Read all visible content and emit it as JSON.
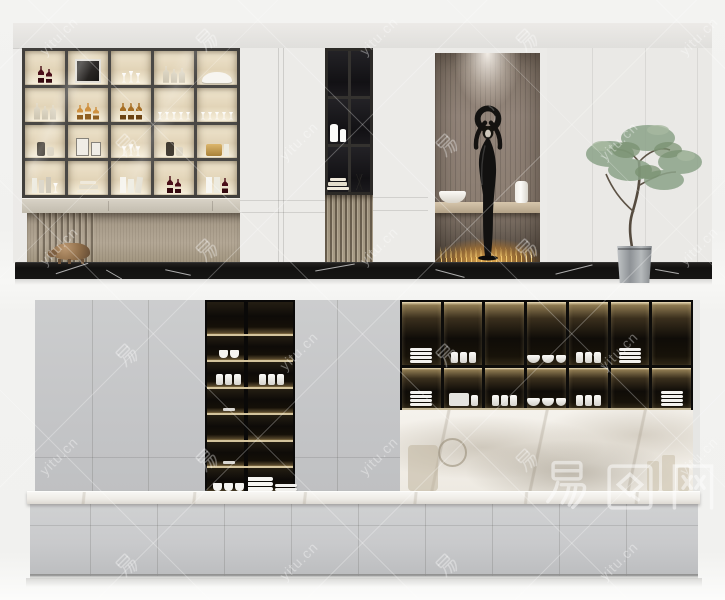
{
  "scene": {
    "description": "two-panel 3d render of modern cabinetry",
    "panels": [
      {
        "name": "display-wall",
        "elements": [
          "glass-display-cabinet",
          "white-cabinets",
          "dark-shelf-unit",
          "statue-niche",
          "paneled-wall",
          "potted-tree",
          "brass-pig-sculpture",
          "black-marble-plinth"
        ]
      },
      {
        "name": "kitchen-wall",
        "elements": [
          "grey-upper-cabinets",
          "dark-open-shelf-column",
          "dark-dish-cabinet",
          "marble-backsplash",
          "marble-countertop",
          "grey-base-drawers"
        ]
      }
    ]
  },
  "watermark": {
    "site_text": "yitu.cn",
    "cn_char": "易",
    "logo_text": "易图网"
  },
  "colors": {
    "shelf_glow": "#efe5ce",
    "warm_light": "#f0e2bc",
    "black_marble": "#141312",
    "kitchen_grey": "#c7c8ca",
    "wood": "#b3a795",
    "foliage": "#8ca389"
  },
  "display_cabinet": {
    "columns": 5,
    "rows": 4,
    "cells": [
      [
        "red-wine-2",
        "art-frame",
        "stem-glasses",
        "clear-bottles-3",
        "white-decor"
      ],
      [
        "clear-bottles-3",
        "amber-bottles-3",
        "whiskey-3",
        "glasses-row",
        "glasses-row"
      ],
      [
        "decanter",
        "photo-frames",
        "stem-glasses",
        "decanter",
        "gold-decor"
      ],
      [
        "books-vertical",
        "books-stack",
        "books-white",
        "red-wine-2",
        "books-white-bottle"
      ]
    ]
  },
  "dark_unit_cells": [
    [
      "",
      ""
    ],
    [
      "vases2",
      ""
    ],
    [
      "books-stack",
      "branch"
    ]
  ],
  "niche_objects": [
    "black-figure-statue",
    "white-bowl-dish",
    "white-vase",
    "warm-light-grass"
  ],
  "kitchen": {
    "upper_dark_cabinet": {
      "columns": 7,
      "rows": 2,
      "cells": [
        [
          "plates",
          "canisters",
          "",
          "bowls",
          "canisters",
          "plates",
          ""
        ],
        [
          "plates",
          "box",
          "canisters",
          "bowls",
          "canisters",
          "",
          "plates"
        ]
      ]
    },
    "mid_column_rows": [
      {
        "left": "",
        "right": ""
      },
      {
        "left": "cups2",
        "right": ""
      },
      {
        "left": "canisters",
        "right": "canisters"
      },
      {
        "left": "dash",
        "right": ""
      },
      {
        "left": "",
        "right": ""
      },
      {
        "left": "dash",
        "right": ""
      },
      {
        "left": "smallbowls",
        "right": "plates2"
      }
    ]
  }
}
